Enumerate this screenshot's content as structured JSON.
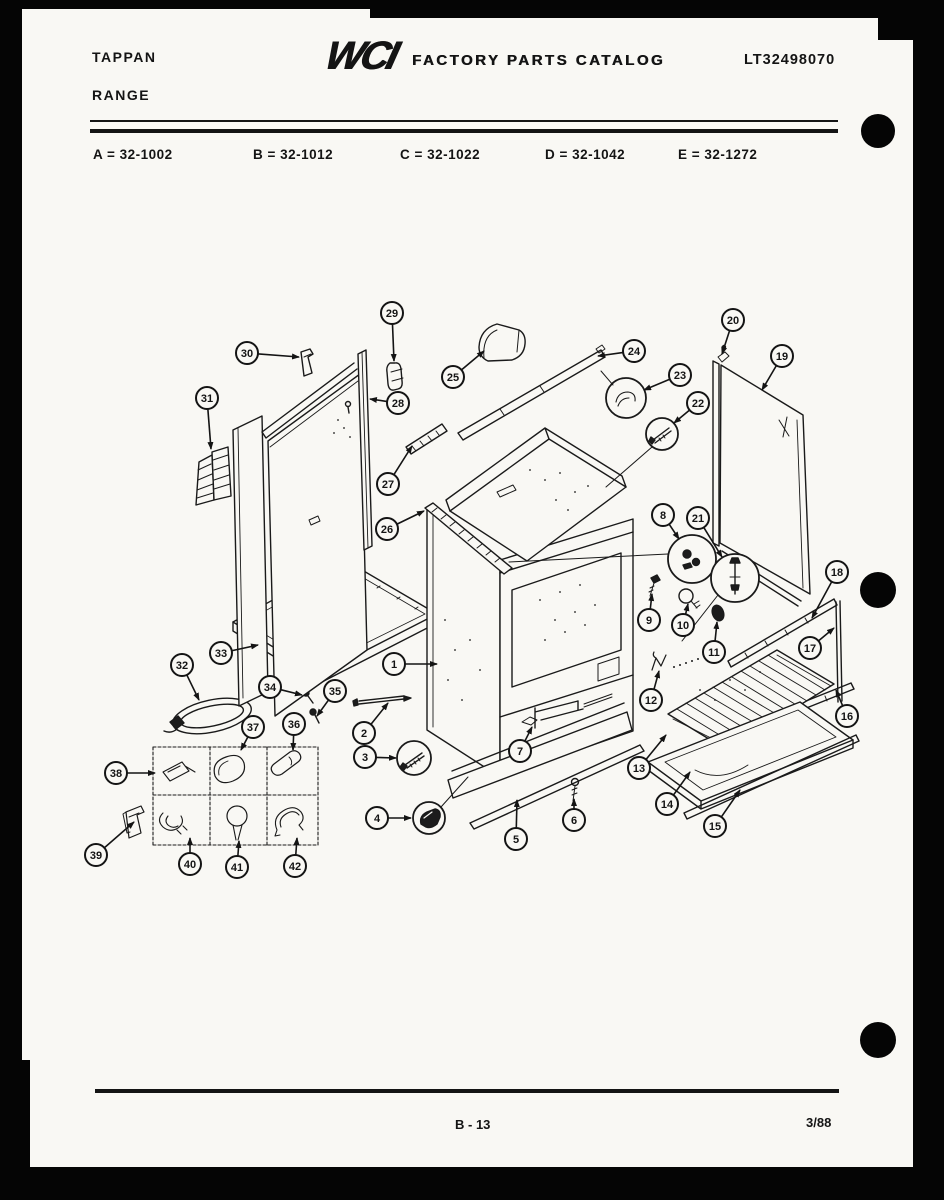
{
  "page": {
    "brand_line1": "TAPPAN",
    "brand_line2": "RANGE",
    "logo_text": "WCI",
    "catalog_title": "FACTORY PARTS CATALOG",
    "catalog_number": "LT32498070",
    "models": [
      "A = 32-1002",
      "B = 32-1012",
      "C = 32-1022",
      "D = 32-1042",
      "E = 32-1272"
    ],
    "footer": {
      "page_number": "B - 13",
      "date_code": "3/88"
    }
  },
  "diagram": {
    "description": "Exploded parts diagram of range body, cabinet panels, oven rack and hardware",
    "callouts": [
      {
        "n": "1",
        "cx": 394,
        "cy": 664,
        "tx": 437,
        "ty": 664
      },
      {
        "n": "2",
        "cx": 364,
        "cy": 733,
        "tx": 388,
        "ty": 703
      },
      {
        "n": "3",
        "cx": 365,
        "cy": 757,
        "tx": 396,
        "ty": 758
      },
      {
        "n": "4",
        "cx": 377,
        "cy": 818,
        "tx": 411,
        "ty": 818
      },
      {
        "n": "5",
        "cx": 516,
        "cy": 839,
        "tx": 517,
        "ty": 800
      },
      {
        "n": "6",
        "cx": 574,
        "cy": 820,
        "tx": 574,
        "ty": 799
      },
      {
        "n": "7",
        "cx": 520,
        "cy": 751,
        "tx": 532,
        "ty": 727
      },
      {
        "n": "8",
        "cx": 663,
        "cy": 515,
        "tx": 679,
        "ty": 539
      },
      {
        "n": "9",
        "cx": 649,
        "cy": 620,
        "tx": 652,
        "ty": 594
      },
      {
        "n": "10",
        "cx": 683,
        "cy": 625,
        "tx": 688,
        "ty": 604
      },
      {
        "n": "11",
        "cx": 714,
        "cy": 652,
        "tx": 717,
        "ty": 622
      },
      {
        "n": "12",
        "cx": 651,
        "cy": 700,
        "tx": 659,
        "ty": 671
      },
      {
        "n": "13",
        "cx": 639,
        "cy": 768,
        "tx": 666,
        "ty": 735
      },
      {
        "n": "14",
        "cx": 667,
        "cy": 804,
        "tx": 690,
        "ty": 772
      },
      {
        "n": "15",
        "cx": 715,
        "cy": 826,
        "tx": 740,
        "ty": 790
      },
      {
        "n": "16",
        "cx": 847,
        "cy": 716,
        "tx": 836,
        "ty": 690
      },
      {
        "n": "17",
        "cx": 810,
        "cy": 648,
        "tx": 834,
        "ty": 628
      },
      {
        "n": "18",
        "cx": 837,
        "cy": 572,
        "tx": 812,
        "ty": 618
      },
      {
        "n": "19",
        "cx": 782,
        "cy": 356,
        "tx": 762,
        "ty": 390
      },
      {
        "n": "20",
        "cx": 733,
        "cy": 320,
        "tx": 722,
        "ty": 354
      },
      {
        "n": "21",
        "cx": 698,
        "cy": 518,
        "tx": 722,
        "ty": 557
      },
      {
        "n": "22",
        "cx": 698,
        "cy": 403,
        "tx": 674,
        "ty": 423
      },
      {
        "n": "23",
        "cx": 680,
        "cy": 375,
        "tx": 644,
        "ty": 390
      },
      {
        "n": "24",
        "cx": 634,
        "cy": 351,
        "tx": 598,
        "ty": 356
      },
      {
        "n": "25",
        "cx": 453,
        "cy": 377,
        "tx": 484,
        "ty": 351
      },
      {
        "n": "26",
        "cx": 387,
        "cy": 529,
        "tx": 424,
        "ty": 511
      },
      {
        "n": "27",
        "cx": 388,
        "cy": 484,
        "tx": 412,
        "ty": 446
      },
      {
        "n": "28",
        "cx": 398,
        "cy": 403,
        "tx": 370,
        "ty": 399
      },
      {
        "n": "29",
        "cx": 392,
        "cy": 313,
        "tx": 394,
        "ty": 361
      },
      {
        "n": "30",
        "cx": 247,
        "cy": 353,
        "tx": 299,
        "ty": 357
      },
      {
        "n": "31",
        "cx": 207,
        "cy": 398,
        "tx": 211,
        "ty": 449
      },
      {
        "n": "32",
        "cx": 182,
        "cy": 665,
        "tx": 199,
        "ty": 700
      },
      {
        "n": "33",
        "cx": 221,
        "cy": 653,
        "tx": 258,
        "ty": 645
      },
      {
        "n": "34",
        "cx": 270,
        "cy": 687,
        "tx": 302,
        "ty": 695
      },
      {
        "n": "35",
        "cx": 335,
        "cy": 691,
        "tx": 317,
        "ty": 716
      },
      {
        "n": "36",
        "cx": 294,
        "cy": 724,
        "tx": 293,
        "ty": 750
      },
      {
        "n": "37",
        "cx": 253,
        "cy": 727,
        "tx": 241,
        "ty": 750
      },
      {
        "n": "38",
        "cx": 116,
        "cy": 773,
        "tx": 155,
        "ty": 773
      },
      {
        "n": "39",
        "cx": 96,
        "cy": 855,
        "tx": 134,
        "ty": 822
      },
      {
        "n": "40",
        "cx": 190,
        "cy": 864,
        "tx": 190,
        "ty": 838
      },
      {
        "n": "41",
        "cx": 237,
        "cy": 867,
        "tx": 239,
        "ty": 841
      },
      {
        "n": "42",
        "cx": 295,
        "cy": 866,
        "tx": 297,
        "ty": 838
      }
    ]
  },
  "colors": {
    "ink": "#141414",
    "paper": "#f9f8f4",
    "scan_border": "#050505"
  }
}
